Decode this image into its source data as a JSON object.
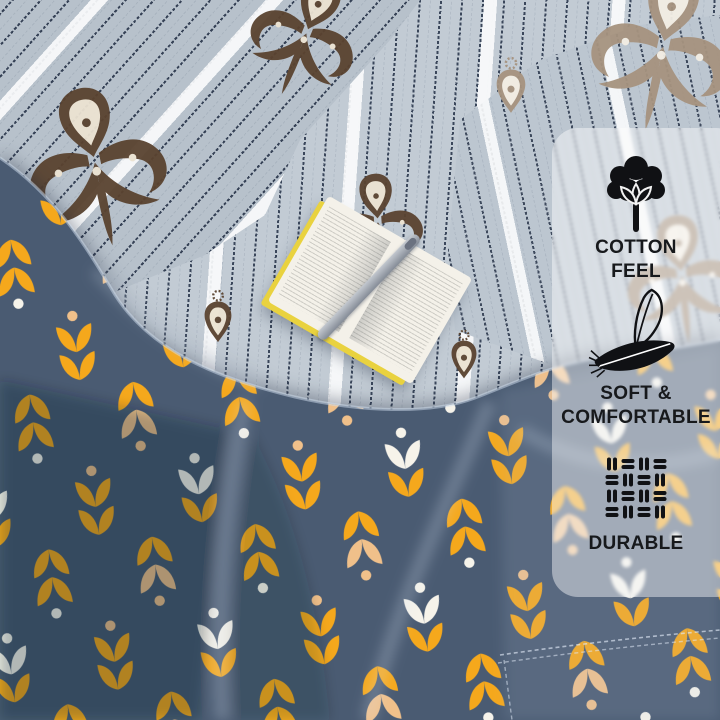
{
  "badges": [
    {
      "icon": "cotton-icon",
      "lines": [
        "COTTON",
        "FEEL"
      ]
    },
    {
      "icon": "feather-icon",
      "lines": [
        "SOFT &",
        "COMFORTABLE"
      ]
    },
    {
      "icon": "weave-icon",
      "lines": [
        "DURABLE"
      ]
    }
  ],
  "colors": {
    "badge_text": "#17191c",
    "icon": "#101114",
    "panel_overlay": "#ffffff",
    "sheet_base": "#c2cbd4",
    "stripe_dark": "#3a4860",
    "duvet_base": "#4a5b72",
    "duvet_dark": "#36475d",
    "tulip_yellow": "#f5a81c",
    "tulip_peach": "#f0c08a",
    "tulip_white": "#f6f3ea",
    "damask_brown": "#5a4330",
    "damask_taupe": "#a6937f",
    "book_page": "#f4f1e9",
    "book_cover": "#e9d23f"
  }
}
